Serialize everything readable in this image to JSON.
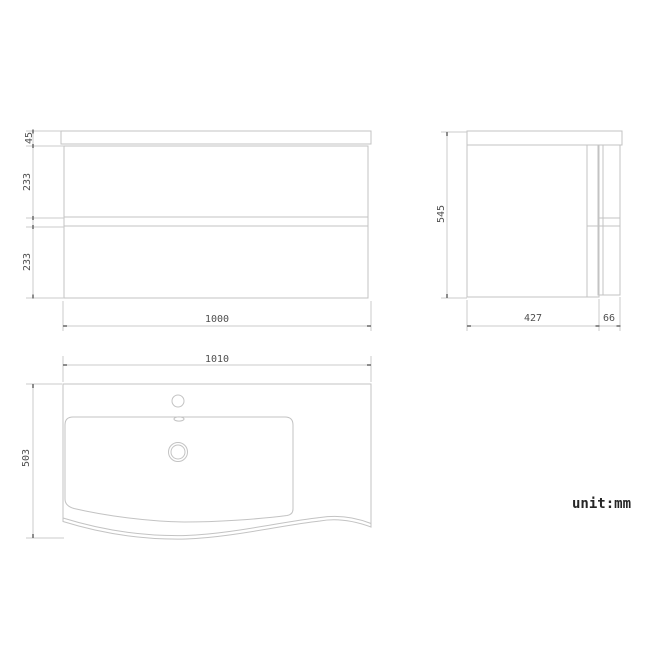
{
  "drawing": {
    "title": "vanity-unit-technical-drawing",
    "unit_note": "unit:mm",
    "front_view": {
      "name": "front view of wall-hung vanity cabinet",
      "countertop_height_label": "45",
      "top_drawer_height_label": "233",
      "bottom_drawer_height_label": "233",
      "overall_width_label": "1000"
    },
    "side_view": {
      "name": "side view of cabinet",
      "overall_height_label": "545",
      "body_depth_label": "427",
      "drawer_front_depth_label": "66"
    },
    "plan_view": {
      "name": "top plan view of basin",
      "overall_width_label": "1010",
      "overall_depth_label": "503",
      "features": [
        "faucet-hole",
        "overflow-slot",
        "drain-hole",
        "basin-bowl",
        "curved-front-edge"
      ]
    },
    "colors": {
      "background": "#ffffff",
      "outline_line": "#c3c3c3",
      "dimension_line": "#cbcbcb",
      "tick_mark": "#717171",
      "dimension_text": "#4f4f4f",
      "unit_text": "#262626"
    }
  }
}
